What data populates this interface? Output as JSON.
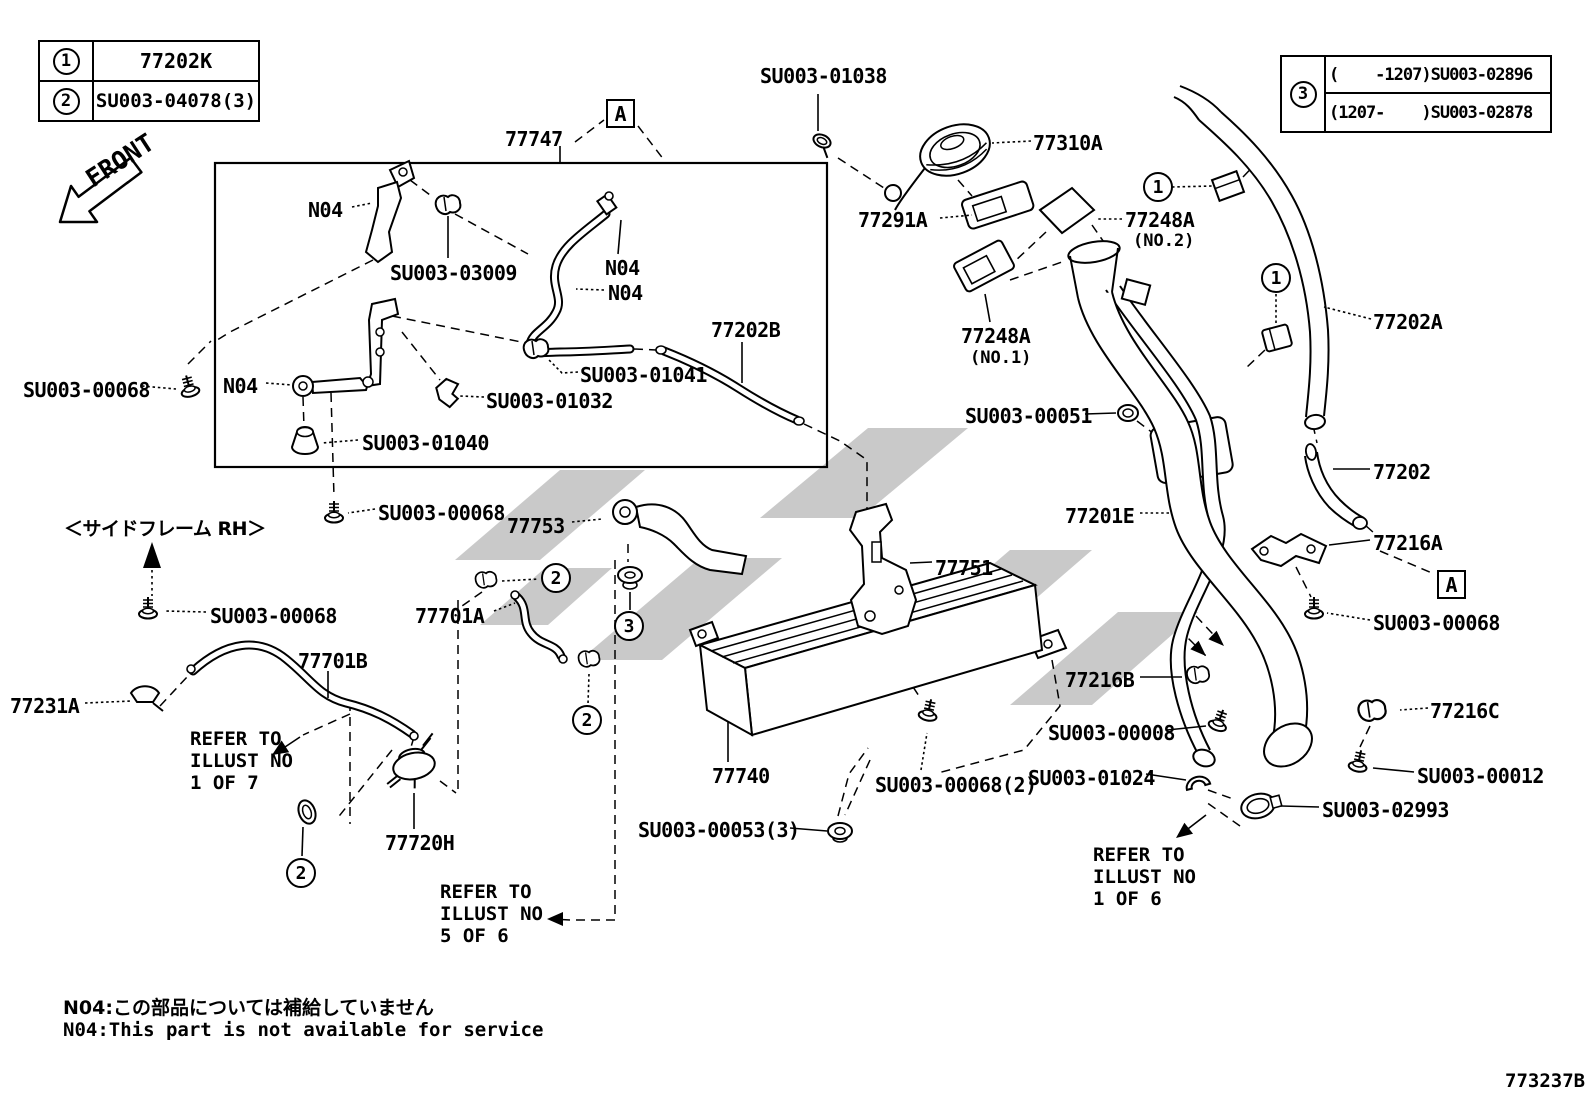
{
  "page": {
    "front_label": "FRONT",
    "drawing_number": "773237B",
    "side_frame_note": "＜サイドフレーム RH＞",
    "notes": {
      "jp": "N04:この部品については補給していません",
      "en": "N04:This part is not available for service"
    }
  },
  "ref_table_left": {
    "rows": [
      {
        "marker": "1",
        "part_no": "77202K"
      },
      {
        "marker": "2",
        "part_no": "SU003-04078(3)"
      }
    ]
  },
  "ref_table_right": {
    "marker": "3",
    "rows": [
      {
        "range": "(    -1207)",
        "part_no": "SU003-02896"
      },
      {
        "range": "(1207-    )",
        "part_no": "SU003-02878"
      }
    ]
  },
  "detail_markers": {
    "top": "A",
    "right": "A"
  },
  "callout_circles": {
    "c1_filler_top": "1",
    "c1_hose_clamp": "1",
    "c2_clip_upper": "2",
    "c3_grommet_nut": "3",
    "c2_clip_lower": "2",
    "c2_hose_clamp_left": "2"
  },
  "labels": {
    "asm_77747": "77747",
    "su003_01038": "SU003-01038",
    "p77310a": "77310A",
    "p77291a": "77291A",
    "p77248a_no2": "77248A",
    "p77248a_no2_sub": "(NO.2)",
    "p77248a_no1": "77248A",
    "p77248a_no1_sub": "(NO.1)",
    "p77202a": "77202A",
    "p77202": "77202",
    "su003_00051": "SU003-00051",
    "p77201e": "77201E",
    "p77216a": "77216A",
    "su003_00068_right": "SU003-00068",
    "p77216b": "77216B",
    "su003_00008": "SU003-00008",
    "su003_01024": "SU003-01024",
    "p77216c": "77216C",
    "su003_00012": "SU003-00012",
    "su003_02993": "SU003-02993",
    "n04_top_bracket": "N04",
    "su003_03009": "SU003-03009",
    "n04_hose_upper": "N04",
    "n04_hose_lower": "N04",
    "p77202b": "77202B",
    "su003_01041": "SU003-01041",
    "su003_01032": "SU003-01032",
    "n04_bottom_bracket": "N04",
    "su003_01040": "SU003-01040",
    "su003_00068_box_left": "SU003-00068",
    "su003_00068_box_below": "SU003-00068",
    "su003_00068_sideframe": "SU003-00068",
    "p77231a": "77231A",
    "p77701b": "77701B",
    "p77753": "77753",
    "p77701a": "77701A",
    "p77751": "77751",
    "p77740": "77740",
    "su003_00068_x2": "SU003-00068(2)",
    "su003_00053_x3": "SU003-00053(3)",
    "p77720h": "77720H"
  },
  "refer_notes": {
    "illust_1_of_7": "REFER TO\nILLUST NO\n1 OF 7",
    "illust_5_of_6": "REFER TO\nILLUST NO\n5 OF 6",
    "illust_1_of_6": "REFER TO\nILLUST NO\n1 OF 6"
  }
}
